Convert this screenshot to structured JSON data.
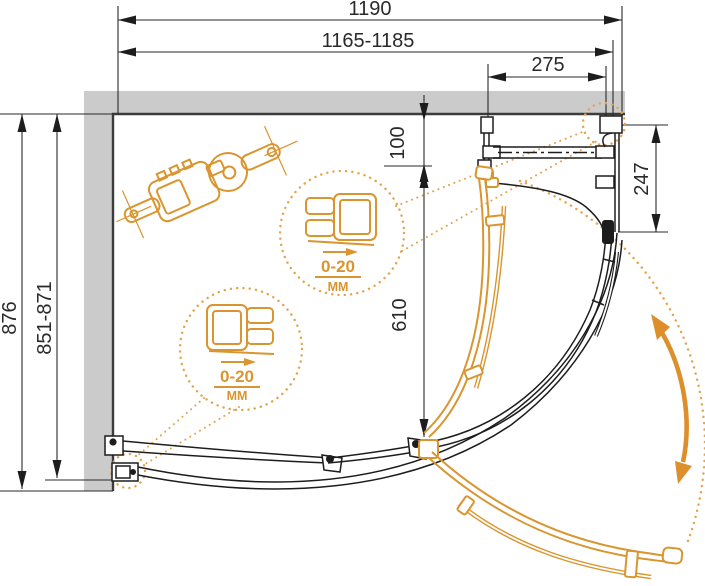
{
  "drawing": {
    "dimensions": {
      "width_overall": "1190",
      "width_adjust": "1165-1185",
      "top_panel": "275",
      "depth_overall": "876",
      "depth_adjust": "851-871",
      "right_panel": "247",
      "wall_to_door": "100",
      "door_opening": "610"
    },
    "callout_upper": {
      "value": "0-20",
      "unit": "ММ"
    },
    "callout_lower": {
      "value": "0-20",
      "unit": "ММ"
    },
    "colors": {
      "accent": "#D9952F",
      "wall": "#CBCBCB",
      "line": "#1D1D1D"
    }
  }
}
